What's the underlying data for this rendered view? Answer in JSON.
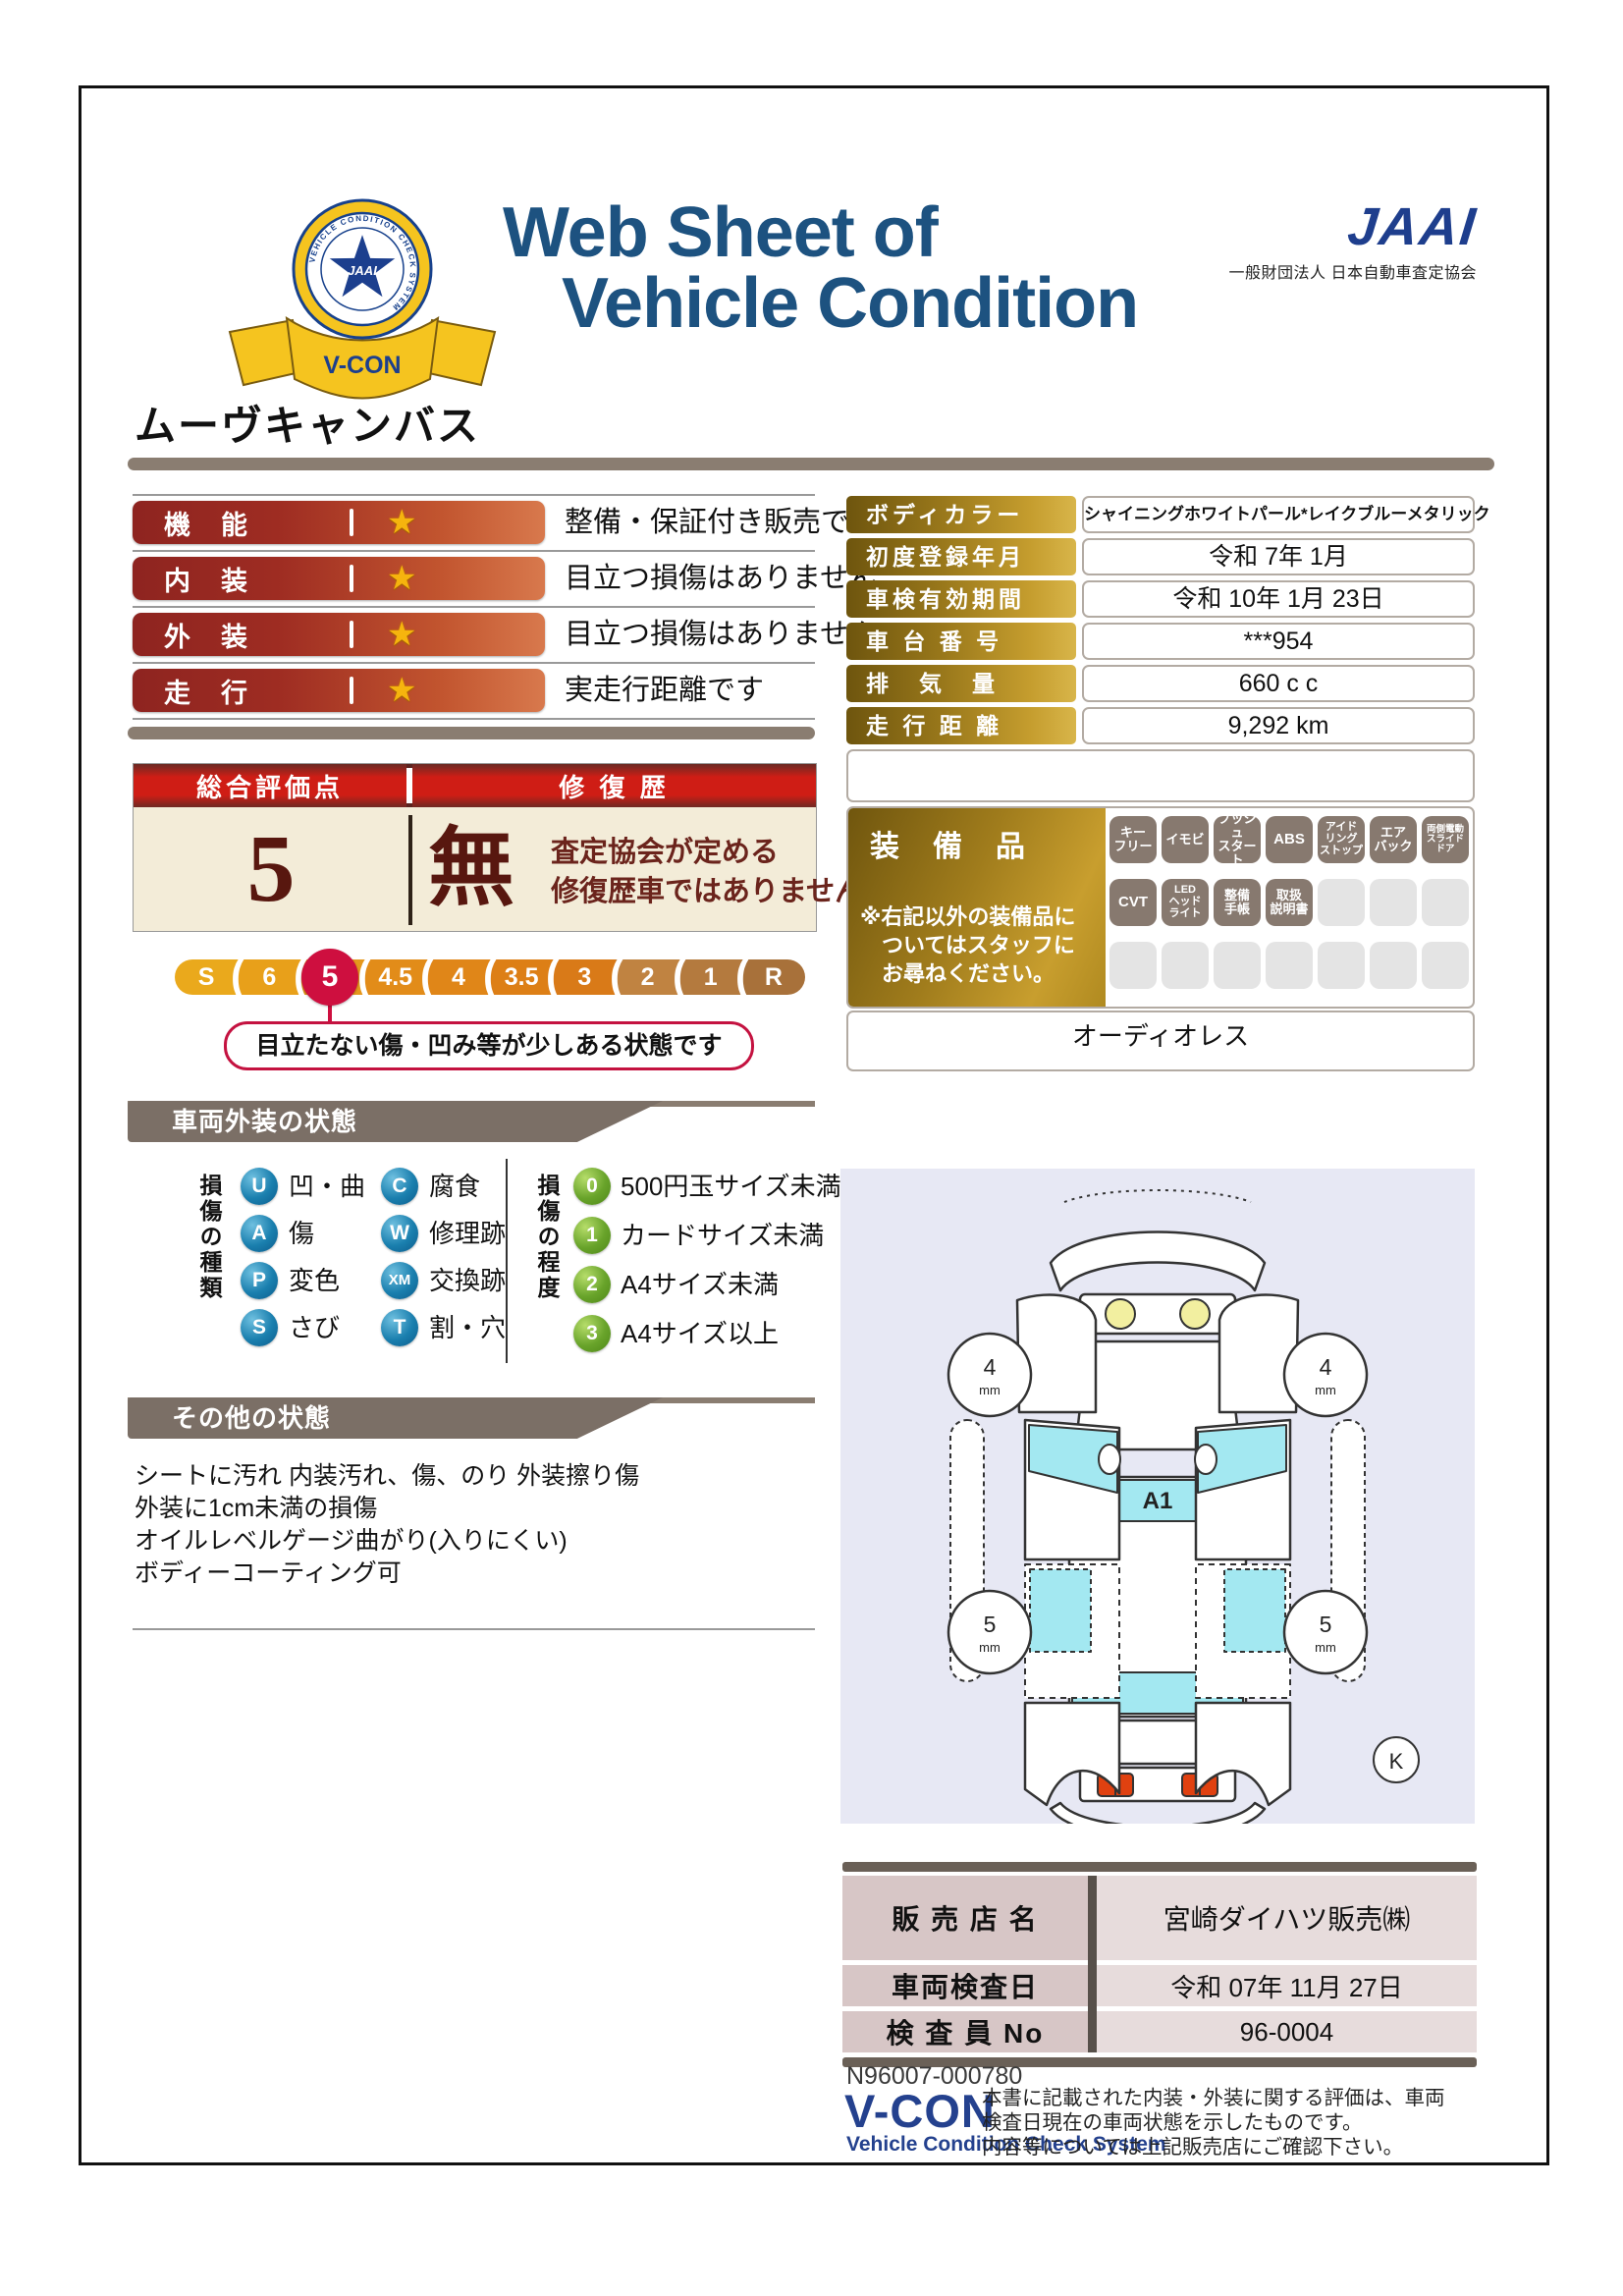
{
  "colors": {
    "title_navy": "#1d5280",
    "jaai_blue": "#1e3e8d",
    "taupe_bar": "#8a7d71",
    "rating_pill_red": "#9e2c22",
    "gold_label": "#c59d2e",
    "score_header_red": "#cf1d15",
    "cream": "#f3ecd8",
    "active_score_red": "#ce0f3f",
    "badge_brown": "#87796f",
    "glass_cyan": "#a3e8f1",
    "diagram_bg": "#e7e8f4"
  },
  "header": {
    "title_line1": "Web Sheet of",
    "title_line2": "Vehicle Condition",
    "jaai_logo": "JAAI",
    "jaai_subtitle": "一般財団法人 日本自動車査定協会",
    "badge_ring_text": "VEHICLE CONDITION CHECK SYSTEM",
    "badge_star_text": "JAAI",
    "badge_ribbon_text": "V-CON"
  },
  "vehicle_name": "ムーヴキャンバス",
  "ratings": [
    {
      "label": "機　能",
      "star": "★",
      "description": "整備・保証付き販売です"
    },
    {
      "label": "内　装",
      "star": "★",
      "description": "目立つ損傷はありません"
    },
    {
      "label": "外　装",
      "star": "★",
      "description": "目立つ損傷はありません"
    },
    {
      "label": "走　行",
      "star": "★",
      "description": "実走行距離です"
    }
  ],
  "details": [
    {
      "label": "ボディカラー",
      "value": "シャイニングホワイトパール*レイクブルーメタリック"
    },
    {
      "label": "初度登録年月",
      "value": "令和 7年 1月"
    },
    {
      "label": "車検有効期間",
      "value": "令和 10年 1月 23日"
    },
    {
      "label": "車 台 番 号",
      "value": "***954"
    },
    {
      "label": "排　気　量",
      "value": "660 c c"
    },
    {
      "label": "走 行 距 離",
      "value": "9,292 km"
    }
  ],
  "overall": {
    "header_left": "総合評価点",
    "header_right": "修 復 歴",
    "score": "5",
    "repair_status": "無",
    "repair_note_line1": "査定協会が定める",
    "repair_note_line2": "修復歴車ではありません",
    "separator": "(",
    "scale": [
      "S",
      "6",
      "5",
      "4.5",
      "4",
      "3.5",
      "3",
      "2",
      "1",
      "R"
    ],
    "active_value": "5",
    "callout": "目立たない傷・凹み等が少しある状態です"
  },
  "equipment": {
    "label": "装　備　品",
    "note_line1": "※右記以外の装備品に",
    "note_line2": "ついてはスタッフに",
    "note_line3": "お尋ねください。",
    "badges": [
      {
        "label": "キー\nフリー",
        "on": true
      },
      {
        "label": "イモビ",
        "on": true
      },
      {
        "label": "プッシュ\nスタート",
        "on": true
      },
      {
        "label": "ABS",
        "on": true
      },
      {
        "label": "アイド\nリング\nストップ",
        "on": true
      },
      {
        "label": "エア\nバック",
        "on": true
      },
      {
        "label": "両側電動\nスライド\nドア",
        "on": true
      },
      {
        "label": "CVT",
        "on": true
      },
      {
        "label": "LED\nヘッド\nライト",
        "on": true
      },
      {
        "label": "整備\n手帳",
        "on": true
      },
      {
        "label": "取扱\n説明書",
        "on": true
      },
      {
        "label": "",
        "on": false
      },
      {
        "label": "",
        "on": false
      },
      {
        "label": "",
        "on": false
      },
      {
        "label": "",
        "on": false
      },
      {
        "label": "",
        "on": false
      },
      {
        "label": "",
        "on": false
      },
      {
        "label": "",
        "on": false
      },
      {
        "label": "",
        "on": false
      },
      {
        "label": "",
        "on": false
      },
      {
        "label": "",
        "on": false
      }
    ],
    "audio_note": "オーディオレス"
  },
  "exterior": {
    "title": "車両外装の状態",
    "type_label": "損傷の種類",
    "types": [
      {
        "code": "U",
        "label": "凹・曲"
      },
      {
        "code": "C",
        "label": "腐食"
      },
      {
        "code": "A",
        "label": "傷"
      },
      {
        "code": "W",
        "label": "修理跡"
      },
      {
        "code": "P",
        "label": "変色"
      },
      {
        "code": "XM",
        "label": "交換跡"
      },
      {
        "code": "S",
        "label": "さび"
      },
      {
        "code": "T",
        "label": "割・穴"
      }
    ],
    "degree_label": "損傷の程度",
    "degrees": [
      {
        "code": "0",
        "label": "500円玉サイズ未満"
      },
      {
        "code": "1",
        "label": "カードサイズ未満"
      },
      {
        "code": "2",
        "label": "A4サイズ未満"
      },
      {
        "code": "3",
        "label": "A4サイズ以上"
      }
    ]
  },
  "other": {
    "title": "その他の状態",
    "lines": [
      "シートに汚れ 内装汚れ、傷、のり 外装擦り傷",
      "外装に1cm未満の損傷",
      "オイルレベルゲージ曲がり(入りにくい)",
      "ボディーコーティング可"
    ]
  },
  "diagram": {
    "roof_label": "A1",
    "front_wheel_value": "4",
    "rear_wheel_value": "5",
    "unit": "mm",
    "marker": "K"
  },
  "dealer": [
    {
      "label": "販 売 店 名",
      "value": "宮崎ダイハツ販売㈱"
    },
    {
      "label": "車両検査日",
      "value": "令和 07年 11月 27日"
    },
    {
      "label": "検 査 員 No",
      "value": "96-0004"
    }
  ],
  "footer": {
    "serial": "N96007-000780",
    "vcon_logo": "V-CON",
    "vcon_subtitle": "Vehicle Condition Check System",
    "disclaimer_lines": [
      "本書に記載された内装・外装に関する評価は、車両",
      "検査日現在の車両状態を示したものです。",
      "内容等については上記販売店にご確認下さい。"
    ]
  }
}
